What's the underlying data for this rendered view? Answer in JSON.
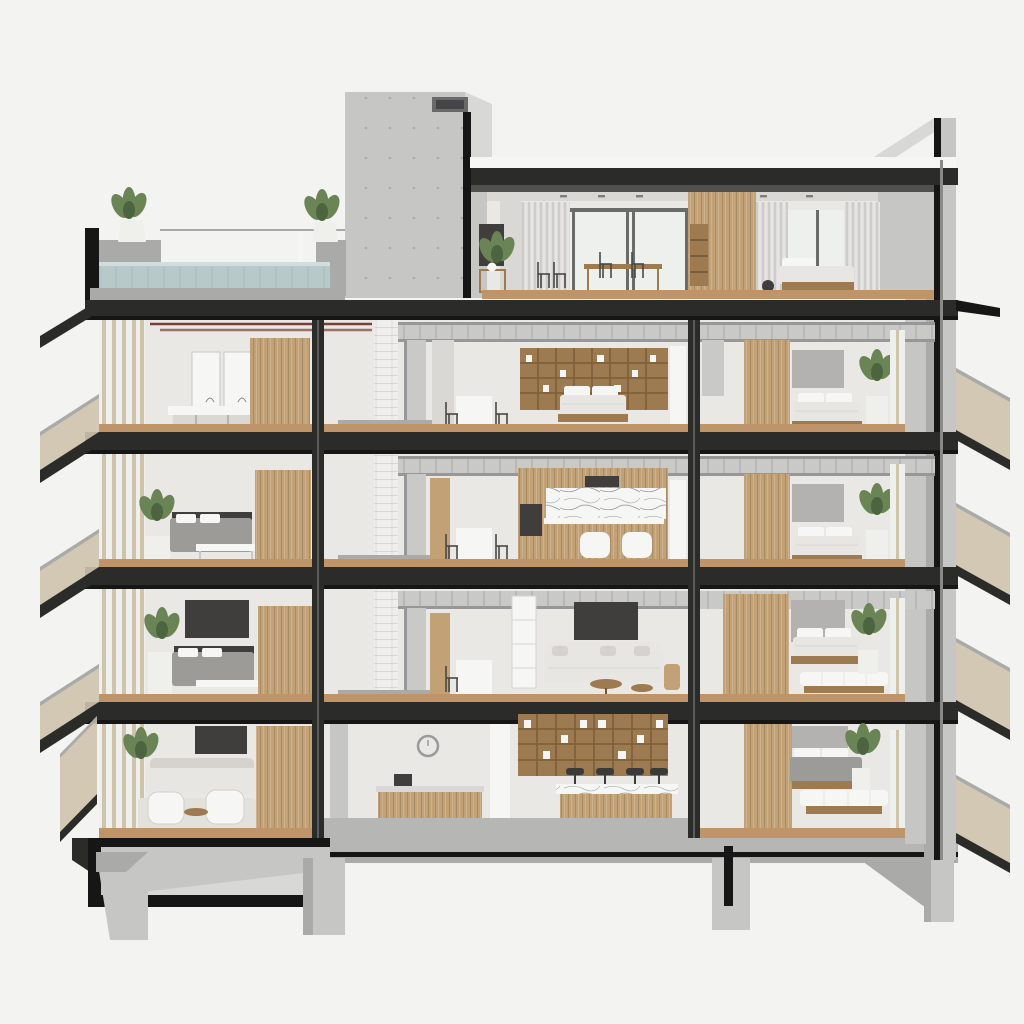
{
  "image": {
    "kind": "architectural cross-section render",
    "title": "Five-level apartment building section",
    "canvas": {
      "width": 1024,
      "height": 1024
    },
    "no_visible_text": true
  },
  "palette": {
    "bg": "#f3f3f1",
    "concrete": "#c6c6c4",
    "concreteLight": "#d8d8d6",
    "concreteDark": "#aaaaa8",
    "concreteFloor": "#b6b6b4",
    "steel": "#2b2b2a",
    "steelMid": "#50504e",
    "black": "#161616",
    "wood": "#c2a176",
    "woodDark": "#9d7a4f",
    "woodFloor": "#bf9468",
    "woodFloorDark": "#a27a50",
    "wall": "#e9e8e5",
    "wallShade": "#d9d8d5",
    "whiteObj": "#f6f6f4",
    "glass": "#eef0ee",
    "curtain": "#dedddb",
    "duct": "#c9c9c7",
    "ductShade": "#97979a",
    "pipeRed": "#7a4038",
    "linen": "#e8e6e2",
    "linenShade": "#d6d3ce",
    "grayBed": "#9d9b97",
    "grayPanel": "#b3b2b0",
    "darkPanel": "#3f3e3c",
    "plant": "#6b8455",
    "plantDark": "#4c6540",
    "potWhite": "#efefec",
    "water": "#b8c9c9",
    "waterLight": "#d2dedd",
    "slatTan": "#cfc3ac",
    "brickWhite": "#efeeec"
  },
  "building": {
    "structure": [
      "concrete service core tower with vent grille",
      "exposed black steel floor slabs and columns",
      "white painted brick services shaft",
      "concrete side walls",
      "concrete foundation piers with open basement void"
    ],
    "floors": [
      {
        "id": "roof",
        "label": "rooftop + penthouse",
        "left": [
          "roof terrace",
          "plunge pool",
          "planters",
          "glass railing"
        ],
        "center": [
          "penthouse lounge",
          "dark wardrobe panel",
          "wire chairs",
          "dining table with chairs",
          "timber closet with bookshelf"
        ],
        "right": [
          "penthouse bedroom",
          "curtains",
          "white bed",
          "side table"
        ]
      },
      {
        "id": "floor4",
        "label": "fourth level",
        "left": [
          "double vanity with mirrors",
          "stools",
          "timber wardrobe"
        ],
        "center": [
          "services shaft",
          "spiral duct run",
          "desk with chairs",
          "bookshelf wall",
          "bed"
        ],
        "right": [
          "bedroom",
          "timber wardrobe",
          "white bed",
          "potted plant"
        ]
      },
      {
        "id": "floor3",
        "label": "third level",
        "left": [
          "bedroom",
          "plants",
          "gray bed",
          "white bench"
        ],
        "center": [
          "kitchen",
          "marble backsplash",
          "oven",
          "marble island",
          "two white armchairs"
        ],
        "right": [
          "bedroom",
          "timber wardrobe",
          "white bed",
          "potted plant"
        ]
      },
      {
        "id": "floor2",
        "label": "second level",
        "left": [
          "bedroom",
          "wall TV",
          "gray bed",
          "plant"
        ],
        "center": [
          "living room",
          "wall TV",
          "sectional sofa",
          "round coffee tables",
          "white shelving"
        ],
        "right": [
          "bedroom",
          "timber wardrobe",
          "bed with futon",
          "potted plant"
        ]
      },
      {
        "id": "ground",
        "label": "ground level",
        "left": [
          "lounge",
          "wall TV",
          "sofa",
          "armchairs on rug",
          "timber volume"
        ],
        "center": [
          "reception desk",
          "wall clock",
          "bar shelving with bottles",
          "bar stools",
          "marble-top bar counter"
        ],
        "right": [
          "bedroom",
          "timber wardrobe",
          "bed with futon",
          "potted plant"
        ]
      }
    ],
    "balconies": {
      "left": 4,
      "right": 4,
      "railing": "vertical tan slats on cantilevered slabs"
    }
  }
}
